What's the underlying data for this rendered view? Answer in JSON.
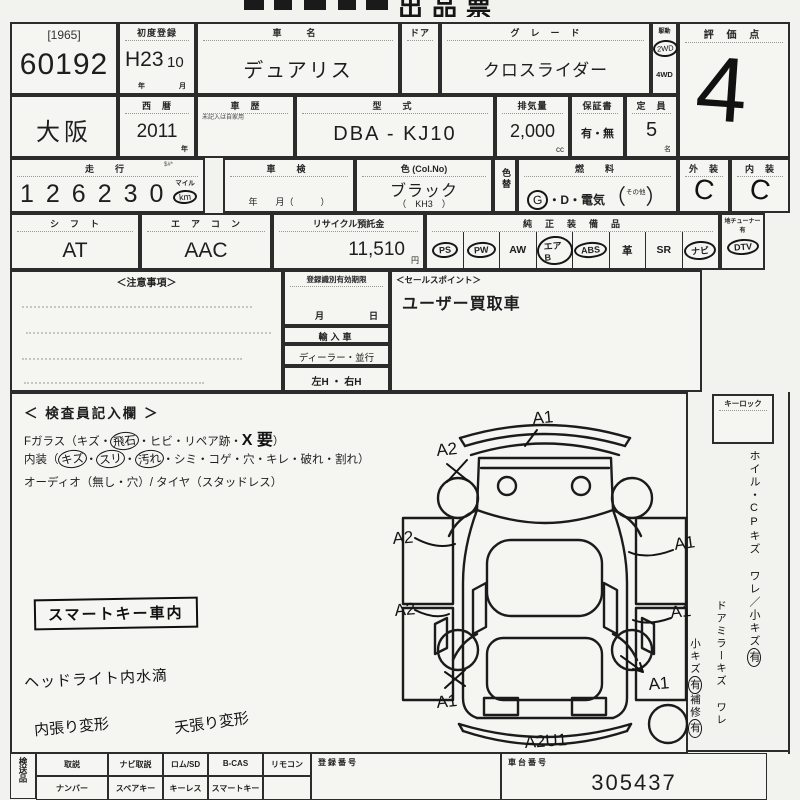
{
  "title": "出品票",
  "lot": {
    "year_tag": "[1965]",
    "number": "60192"
  },
  "first_reg": {
    "label": "初度登録",
    "era": "H23",
    "month": "10",
    "unit_year": "年",
    "unit_month": "月"
  },
  "car_name": {
    "label": "車　名",
    "value": "デュアリス"
  },
  "door": {
    "label": "ドア"
  },
  "grade": {
    "label": "グ　レ　ー　ド",
    "value": "クロスライダー"
  },
  "drive": {
    "label": "駆動",
    "option_2wd": "2WD",
    "option_4wd": "4WD"
  },
  "score": {
    "label": "評 価 点",
    "value": "4"
  },
  "region": {
    "value": "大阪"
  },
  "west_year": {
    "label": "西　暦",
    "value": "2011",
    "unit": "年"
  },
  "history": {
    "label": "車　歴",
    "note": "未記入は自家用"
  },
  "model": {
    "label": "型　式",
    "value": "DBA - KJ10"
  },
  "displacement": {
    "label": "排気量",
    "value": "2,000",
    "unit": "cc"
  },
  "warranty": {
    "label": "保証書",
    "value": "有・無"
  },
  "capacity": {
    "label": "定　員",
    "value": "5",
    "unit": "名"
  },
  "mileage": {
    "label": "走　行",
    "side_mark": "$#*",
    "value": "126230",
    "unit_top": "マイル",
    "unit_km": "km"
  },
  "shaken": {
    "label": "車　検",
    "units": "年　　月（　　　）"
  },
  "color": {
    "label": "色 (Col.No)",
    "value": "ブラック",
    "code": "（　KH3　）"
  },
  "color_change": {
    "label": "色替"
  },
  "fuel": {
    "label": "燃　料",
    "g": "G",
    "rest": "・D・電気",
    "paren_open": "（",
    "other": "その他",
    "paren_close": "）"
  },
  "exterior": {
    "label": "外　装",
    "value": "C"
  },
  "interior_grade": {
    "label": "内　装",
    "value": "C"
  },
  "shift": {
    "label": "シ　フ　ト",
    "value": "AT"
  },
  "aircon": {
    "label": "エ　ア　コ　ン",
    "value": "AAC"
  },
  "recycle": {
    "label": "リサイクル預託金",
    "value": "11,510",
    "unit": "円"
  },
  "equipment": {
    "label": "純　正　装　備　品",
    "items": [
      {
        "name": "PS"
      },
      {
        "name": "PW"
      },
      {
        "name": "AW"
      },
      {
        "name": "エアB"
      },
      {
        "name": "ABS"
      },
      {
        "name": "革"
      },
      {
        "name": "SR"
      },
      {
        "name": "ナビ"
      }
    ],
    "tuner_label": "地チューナー有",
    "tuner": "DTV"
  },
  "notes": {
    "label": "＜注意事項＞"
  },
  "registration": {
    "expiry_label": "登録識別有効期限",
    "month": "月",
    "day": "日",
    "import_label": "輸入車",
    "dealer_parallel": "ディーラー・並行",
    "handle": "左H ・ 右H"
  },
  "sales_point": {
    "label": "＜セールスポイント＞",
    "value": "ユーザー買取車"
  },
  "inspector": {
    "title": "＜ 検査員記入欄 ＞",
    "glass_pre": "Fガラス（キズ・",
    "glass_circled": "飛石",
    "glass_mid": "・ヒビ・リペア跡・",
    "glass_hand": "X 要",
    "glass_post": "）",
    "int_pre": "内装（",
    "int_c1": "キズ",
    "int_d1": "・",
    "int_c2": "スリ",
    "int_d2": "・",
    "int_c3": "汚れ",
    "int_post": "・シミ・コゲ・穴・キレ・破れ・割れ）",
    "audio_line": "オーディオ（無し・穴）/ タイヤ（スタッドレス）",
    "stamp": "スマートキー車内",
    "note_headlight": "ヘッドライト内水滴",
    "note_interior": "内張り変形",
    "note_ceiling": "天張り変形"
  },
  "keylock": {
    "label": "キーロック"
  },
  "side_memo": {
    "line1": "ホイル・CPキズ ワレ／小キズ",
    "line1_mark": "有",
    "line2": "ドアミラーキズ ワレ",
    "line3": "小キズ",
    "line3_mark": "有",
    "line4": "補修",
    "line4_mark": "有"
  },
  "diagram": {
    "front": "A1",
    "front_left": "A2",
    "left_upper": "A2",
    "left_lower": "A2",
    "rear_left": "A1",
    "right_upper": "A1",
    "right_mid": "A1",
    "right_lower": "A1",
    "rear": "A2U1"
  },
  "bottom": {
    "vertical_label": "検送品",
    "row1": [
      "取説",
      "ナビ取説",
      "ロム/SD",
      "B-CAS",
      "リモコン"
    ],
    "row2": [
      "ナンバー",
      "スペアキー",
      "キーレス",
      "スマートキー"
    ],
    "reg_no_label": "登録番号",
    "chassis_label": "車台番号",
    "chassis_value": "305437"
  }
}
